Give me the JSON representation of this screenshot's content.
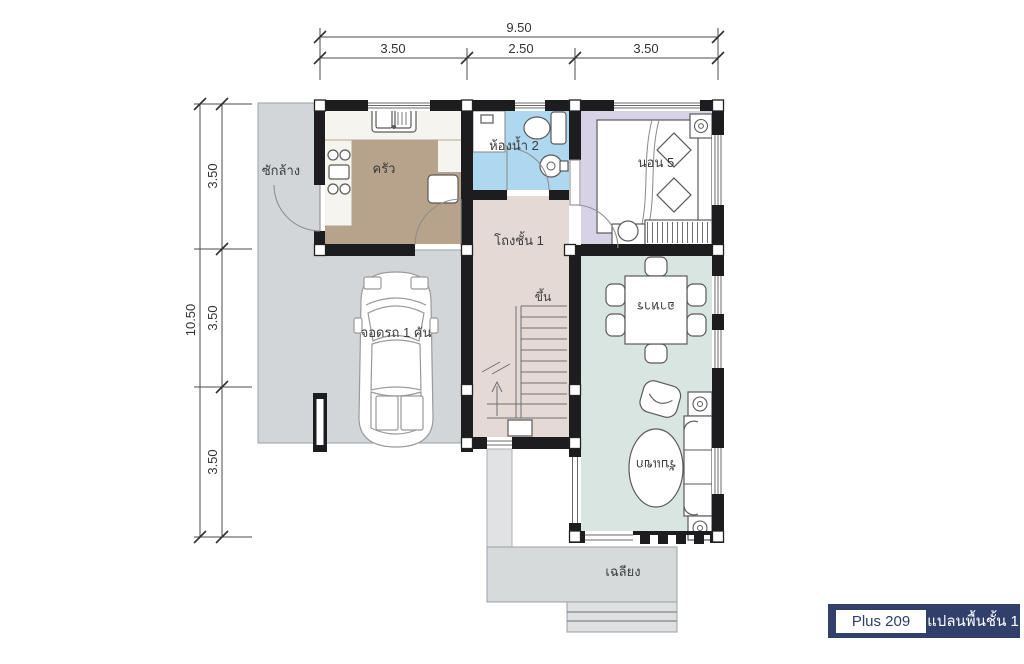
{
  "plan": {
    "title_note": "first floor plan",
    "rooms": {
      "laundry": "ซักล้าง",
      "kitchen": "ครัว",
      "bathroom": "ห้องน้ำ 2",
      "bedroom": "นอน 5",
      "hall": "โถงชั้น 1",
      "stairs_up": "ขึ้น",
      "dining": "อาหาร",
      "living": "รับแขก",
      "carport": "จอดรถ 1 คัน",
      "porch": "เฉลียง"
    },
    "dimensions": {
      "top_total": "9.50",
      "top_segments": [
        "3.50",
        "2.50",
        "3.50"
      ],
      "left_total": "10.50",
      "left_segments": [
        "3.50",
        "3.50",
        "3.50"
      ]
    },
    "badge": {
      "model": "Plus 209",
      "caption": "แปลนพื้นชั้น 1"
    },
    "colors": {
      "wall": "#1d1d1f",
      "kitchen_floor": "#b7a28c",
      "hall_floor": "#e4d9d4",
      "bathroom_floor": "#aed7f0",
      "bedroom_floor": "#d8d2e6",
      "living_dining_floor": "#d9e5e0",
      "slab": "#d2d6d8",
      "porch": "#d7dadb",
      "badge_navy": "#31406b"
    }
  }
}
